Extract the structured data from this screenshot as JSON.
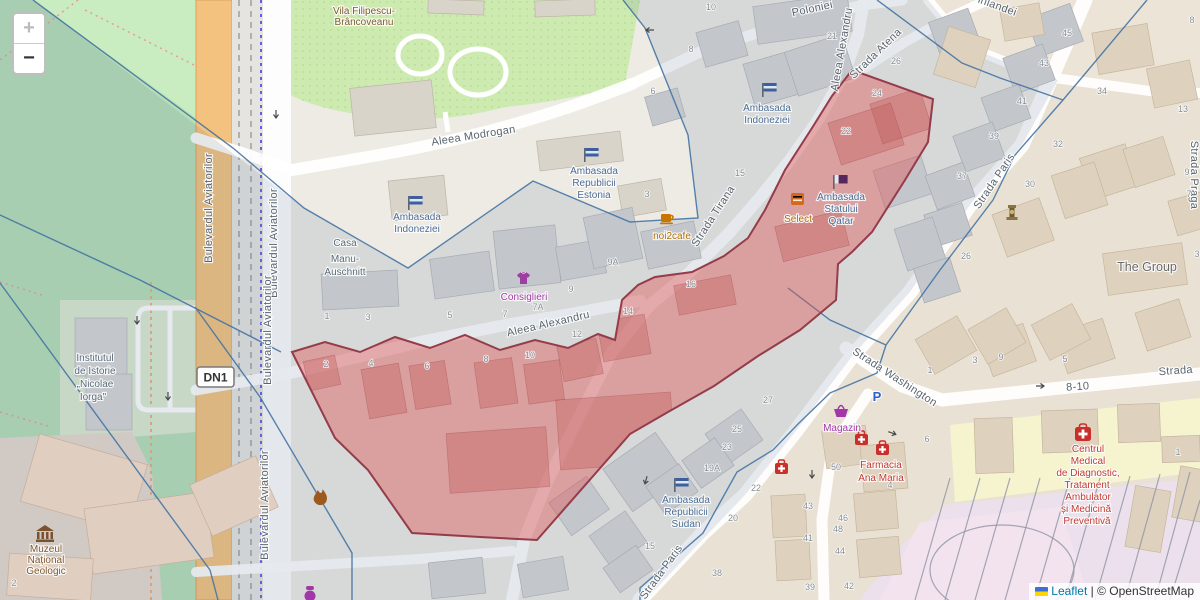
{
  "zoom_control": {
    "zoom_in": "+",
    "zoom_out": "−"
  },
  "attribution": {
    "flag_icon": "ukraine-flag-icon",
    "leaflet": "Leaflet",
    "divider": "|",
    "copyright": "© OpenStreetMap"
  },
  "road_shield": {
    "label": "DN1"
  },
  "parking": {
    "label": "P",
    "x": 877,
    "y": 401
  },
  "colors": {
    "red_fill": "#e05252",
    "red_stroke": "#943c4a",
    "boundary_blue": "#4272a4",
    "road_orange": "#f2c27e",
    "park_green": "#b7dfb7",
    "garden_green": "#cdebb0",
    "embassy_blue": "#4a6b94",
    "shop_purple": "#a238a8",
    "food_orange": "#b06f00",
    "health_red": "#c23b33",
    "heritage_brown": "#7d5a2e",
    "link_blue": "#0078a8",
    "tint": "#587096",
    "yellow_zone": "#f6f3cf",
    "purple_zone": "#ece0ed"
  },
  "icons": [
    "zoom-in-icon",
    "zoom-out-icon",
    "flag-icon",
    "coffee-cup-icon",
    "tshirt-icon",
    "restaurant-icon",
    "basket-icon",
    "pharmacy-icon",
    "hospital-icon",
    "museum-icon",
    "monument-icon",
    "flame-icon",
    "parking-icon",
    "oneway-arrow-icon",
    "ukraine-flag-icon"
  ],
  "street_labels": [
    {
      "t": "Aleea Modrogan",
      "x": 474,
      "y": 139,
      "r": -9
    },
    {
      "t": "Poloniei",
      "x": 813,
      "y": 12,
      "r": -12
    },
    {
      "t": "Aleea Alexandru",
      "x": 845,
      "y": 50,
      "r": -80
    },
    {
      "t": "Strada Atena",
      "x": 878,
      "y": 56,
      "r": -44
    },
    {
      "t": "Strada Tirana",
      "x": 716,
      "y": 218,
      "r": -57
    },
    {
      "t": "Aleea Alexandru",
      "x": 549,
      "y": 327,
      "r": -13
    },
    {
      "t": "Strada Paris",
      "x": 997,
      "y": 183,
      "r": -56
    },
    {
      "t": "Strada Paris",
      "x": 664,
      "y": 574,
      "r": -54
    },
    {
      "t": "Strada Washington",
      "x": 893,
      "y": 380,
      "r": 33
    },
    {
      "t": "Strada Praga",
      "x": 1191,
      "y": 175,
      "r": 90
    },
    {
      "t": "Strada",
      "x": 1176,
      "y": 374,
      "r": -4
    },
    {
      "t": "8-10",
      "x": 1078,
      "y": 390,
      "r": -4
    },
    {
      "t": "Finlandei",
      "x": 993,
      "y": 8,
      "r": 20
    },
    {
      "t": "Bulevardul Aviatorilor",
      "x": 212,
      "y": 208,
      "r": -90
    },
    {
      "t": "Bulevardul Aviatorilor",
      "x": 277,
      "y": 243,
      "r": -90
    },
    {
      "t": "Bulevardul Aviatorilor",
      "x": 271,
      "y": 330,
      "r": -90
    },
    {
      "t": "Bulevardul Aviatorilor",
      "x": 268,
      "y": 505,
      "r": -90
    }
  ],
  "poi_labels": [
    {
      "t": "Vila Filipescu-",
      "x": 364,
      "y": 14,
      "c": "heritage"
    },
    {
      "t": "Brâncoveanu",
      "x": 364,
      "y": 25,
      "c": "heritage"
    },
    {
      "t": "Ambasada",
      "x": 594,
      "y": 174,
      "c": "embassy"
    },
    {
      "t": "Republicii",
      "x": 594,
      "y": 186,
      "c": "embassy"
    },
    {
      "t": "Estonia",
      "x": 594,
      "y": 198,
      "c": "embassy"
    },
    {
      "t": "Ambasada",
      "x": 767,
      "y": 111,
      "c": "embassy"
    },
    {
      "t": "Indoneziei",
      "x": 767,
      "y": 123,
      "c": "embassy"
    },
    {
      "t": "Ambasada",
      "x": 417,
      "y": 220,
      "c": "embassy"
    },
    {
      "t": "Indoneziei",
      "x": 417,
      "y": 232,
      "c": "embassy"
    },
    {
      "t": "Ambasada",
      "x": 841,
      "y": 200,
      "c": "embassy"
    },
    {
      "t": "Statului",
      "x": 841,
      "y": 212,
      "c": "embassy"
    },
    {
      "t": "Qatar",
      "x": 841,
      "y": 224,
      "c": "embassy"
    },
    {
      "t": "Ambasada",
      "x": 686,
      "y": 503,
      "c": "embassy"
    },
    {
      "t": "Republicii",
      "x": 686,
      "y": 515,
      "c": "embassy"
    },
    {
      "t": "Sudan",
      "x": 686,
      "y": 527,
      "c": "embassy"
    },
    {
      "t": "Casa",
      "x": 345,
      "y": 246,
      "c": "muted"
    },
    {
      "t": "Manu-",
      "x": 345,
      "y": 262,
      "c": "muted"
    },
    {
      "t": "Auschnitt",
      "x": 345,
      "y": 275,
      "c": "muted"
    },
    {
      "t": "Institutul",
      "x": 95,
      "y": 361,
      "c": "muted"
    },
    {
      "t": "de Istorie",
      "x": 95,
      "y": 374,
      "c": "muted"
    },
    {
      "t": "„Nicolae",
      "x": 95,
      "y": 387,
      "c": "muted"
    },
    {
      "t": "Iorga\"",
      "x": 93,
      "y": 400,
      "c": "muted"
    },
    {
      "t": "The Group",
      "x": 1147,
      "y": 271,
      "c": "big"
    },
    {
      "t": "Muzeul",
      "x": 46,
      "y": 552,
      "c": "museum"
    },
    {
      "t": "Național",
      "x": 46,
      "y": 563,
      "c": "museum"
    },
    {
      "t": "Geologic",
      "x": 46,
      "y": 574,
      "c": "museum"
    },
    {
      "t": "Consiglieri",
      "x": 524,
      "y": 300,
      "c": "shop"
    },
    {
      "t": "Magazin",
      "x": 842,
      "y": 431,
      "c": "shop"
    },
    {
      "t": "noi2cafe",
      "x": 672,
      "y": 239,
      "c": "food"
    },
    {
      "t": "Select",
      "x": 798,
      "y": 222,
      "c": "food"
    },
    {
      "t": "Farmacia",
      "x": 881,
      "y": 468,
      "c": "health"
    },
    {
      "t": "Ana Maria",
      "x": 881,
      "y": 481,
      "c": "health"
    },
    {
      "t": "Centrul",
      "x": 1088,
      "y": 452,
      "c": "health"
    },
    {
      "t": "Medical",
      "x": 1088,
      "y": 464,
      "c": "health"
    },
    {
      "t": "de Diagnostic,",
      "x": 1088,
      "y": 476,
      "c": "health"
    },
    {
      "t": "Tratament",
      "x": 1087,
      "y": 488,
      "c": "health"
    },
    {
      "t": "Ambulator",
      "x": 1088,
      "y": 500,
      "c": "health"
    },
    {
      "t": "și Medicină",
      "x": 1086,
      "y": 512,
      "c": "health"
    },
    {
      "t": "Preventivă",
      "x": 1087,
      "y": 524,
      "c": "health"
    }
  ],
  "house_numbers": [
    {
      "t": "10",
      "x": 711,
      "y": 10
    },
    {
      "t": "8",
      "x": 691,
      "y": 52
    },
    {
      "t": "6",
      "x": 653,
      "y": 94
    },
    {
      "t": "21",
      "x": 832,
      "y": 39
    },
    {
      "t": "26",
      "x": 896,
      "y": 64
    },
    {
      "t": "24",
      "x": 877,
      "y": 96
    },
    {
      "t": "22",
      "x": 846,
      "y": 134
    },
    {
      "t": "15",
      "x": 740,
      "y": 176
    },
    {
      "t": "3",
      "x": 647,
      "y": 197
    },
    {
      "t": "45",
      "x": 1067,
      "y": 36
    },
    {
      "t": "43",
      "x": 1044,
      "y": 66
    },
    {
      "t": "41",
      "x": 1022,
      "y": 104
    },
    {
      "t": "39",
      "x": 994,
      "y": 139
    },
    {
      "t": "37",
      "x": 962,
      "y": 179
    },
    {
      "t": "8",
      "x": 1192,
      "y": 23
    },
    {
      "t": "34",
      "x": 1102,
      "y": 94
    },
    {
      "t": "32",
      "x": 1058,
      "y": 147
    },
    {
      "t": "30",
      "x": 1030,
      "y": 187
    },
    {
      "t": "13",
      "x": 1183,
      "y": 112
    },
    {
      "t": "9",
      "x": 1187,
      "y": 175
    },
    {
      "t": "7",
      "x": 1189,
      "y": 197
    },
    {
      "t": "26",
      "x": 966,
      "y": 259
    },
    {
      "t": "3",
      "x": 1197,
      "y": 257
    },
    {
      "t": "9",
      "x": 1001,
      "y": 360
    },
    {
      "t": "1",
      "x": 327,
      "y": 319
    },
    {
      "t": "3",
      "x": 368,
      "y": 320
    },
    {
      "t": "5",
      "x": 450,
      "y": 318
    },
    {
      "t": "7",
      "x": 505,
      "y": 317
    },
    {
      "t": "9",
      "x": 571,
      "y": 292
    },
    {
      "t": "9A",
      "x": 613,
      "y": 265
    },
    {
      "t": "12",
      "x": 577,
      "y": 337
    },
    {
      "t": "14",
      "x": 628,
      "y": 314
    },
    {
      "t": "16",
      "x": 691,
      "y": 287
    },
    {
      "t": "7A",
      "x": 538,
      "y": 310
    },
    {
      "t": "2",
      "x": 326,
      "y": 367
    },
    {
      "t": "4",
      "x": 371,
      "y": 366
    },
    {
      "t": "6",
      "x": 427,
      "y": 369
    },
    {
      "t": "8",
      "x": 486,
      "y": 362
    },
    {
      "t": "10",
      "x": 530,
      "y": 358
    },
    {
      "t": "25",
      "x": 737,
      "y": 432
    },
    {
      "t": "23",
      "x": 727,
      "y": 450
    },
    {
      "t": "19A",
      "x": 712,
      "y": 471
    },
    {
      "t": "22",
      "x": 756,
      "y": 491
    },
    {
      "t": "20",
      "x": 733,
      "y": 521
    },
    {
      "t": "15",
      "x": 650,
      "y": 549
    },
    {
      "t": "38",
      "x": 717,
      "y": 576
    },
    {
      "t": "27",
      "x": 768,
      "y": 403
    },
    {
      "t": "43",
      "x": 808,
      "y": 509
    },
    {
      "t": "41",
      "x": 808,
      "y": 541
    },
    {
      "t": "39",
      "x": 810,
      "y": 590
    },
    {
      "t": "50",
      "x": 836,
      "y": 470
    },
    {
      "t": "48",
      "x": 838,
      "y": 532
    },
    {
      "t": "46",
      "x": 843,
      "y": 521
    },
    {
      "t": "44",
      "x": 840,
      "y": 554
    },
    {
      "t": "42",
      "x": 849,
      "y": 589
    },
    {
      "t": "1",
      "x": 930,
      "y": 373
    },
    {
      "t": "3",
      "x": 975,
      "y": 363
    },
    {
      "t": "5",
      "x": 1065,
      "y": 362
    },
    {
      "t": "6",
      "x": 927,
      "y": 442
    },
    {
      "t": "4",
      "x": 890,
      "y": 488
    },
    {
      "t": "1",
      "x": 1178,
      "y": 455
    },
    {
      "t": "2",
      "x": 14,
      "y": 586
    }
  ]
}
